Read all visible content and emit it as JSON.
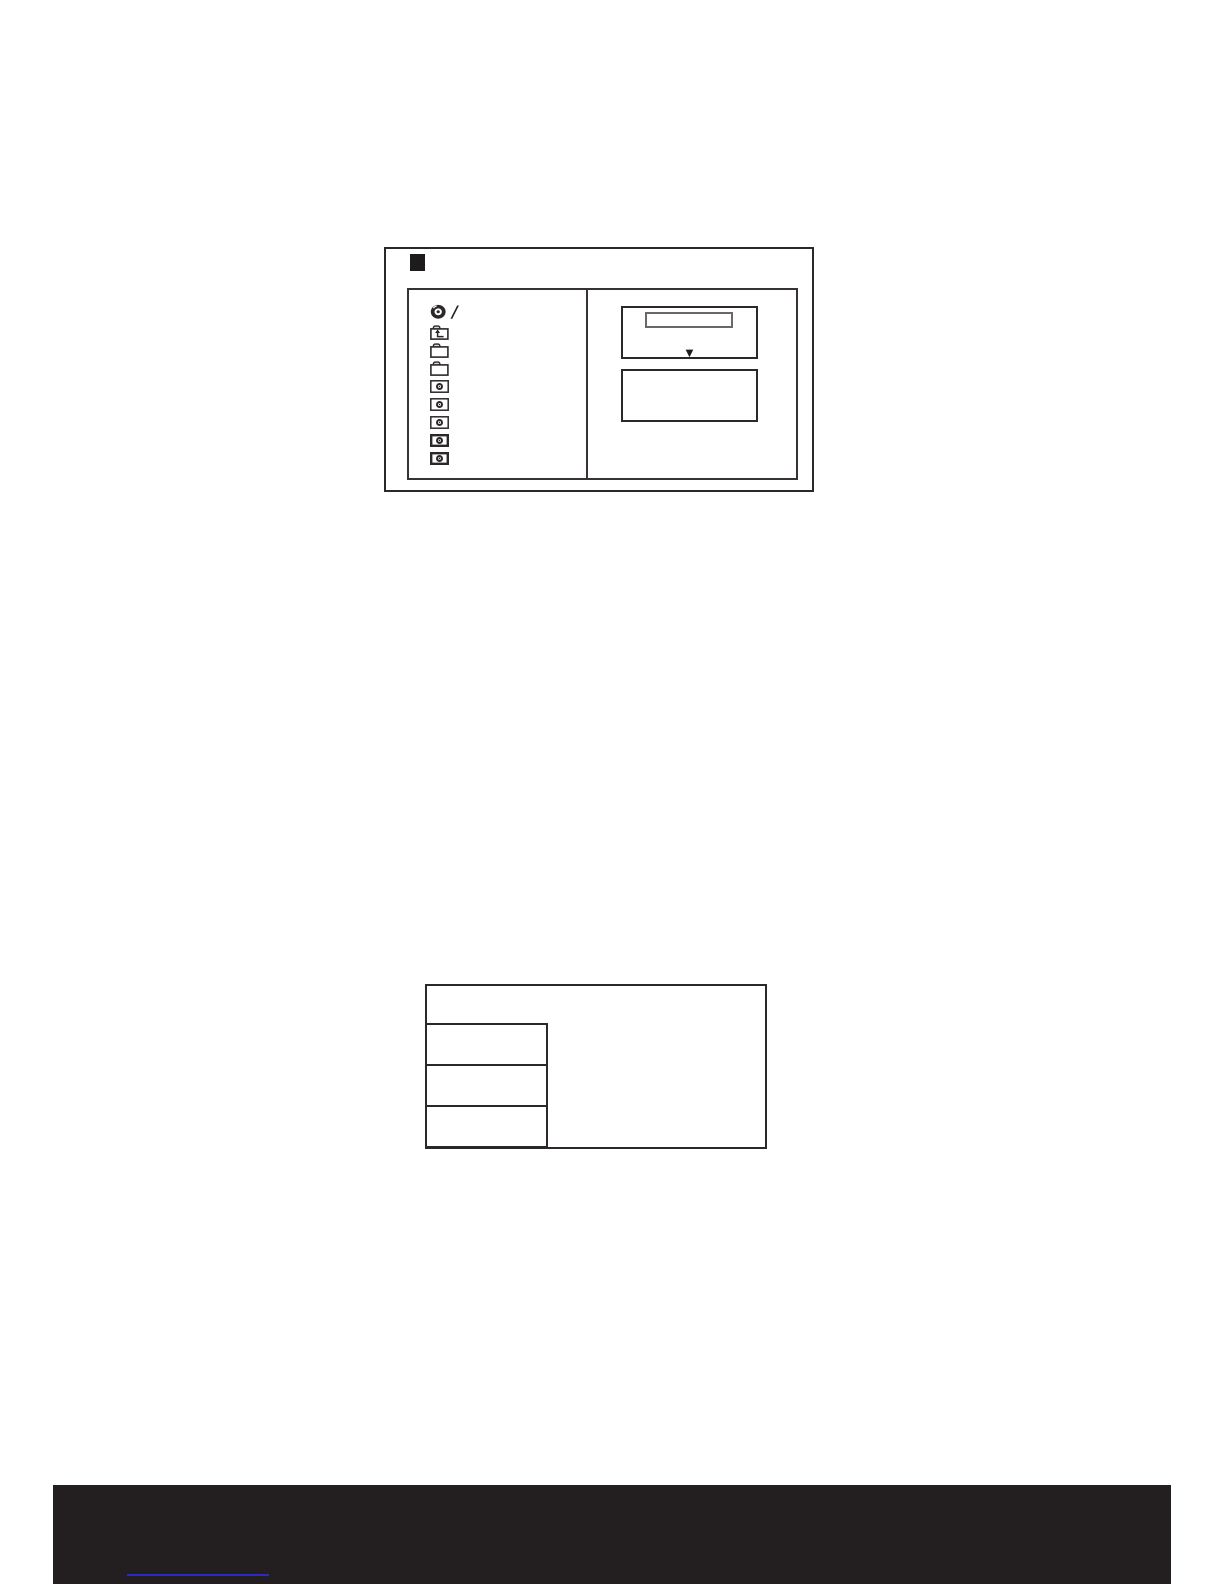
{
  "page": {
    "background": "#ffffff"
  },
  "figure_file_browser": {
    "step_marker_color": "#1e1b1c",
    "file_list": {
      "items": [
        {
          "icon": "disc",
          "label": "/"
        },
        {
          "icon": "folder-up",
          "label": ""
        },
        {
          "icon": "folder",
          "label": ""
        },
        {
          "icon": "folder",
          "label": ""
        },
        {
          "icon": "camera-file",
          "label": ""
        },
        {
          "icon": "camera-file",
          "label": ""
        },
        {
          "icon": "camera-file",
          "label": ""
        },
        {
          "icon": "camera-file",
          "label": "",
          "bold": true
        },
        {
          "icon": "camera-file",
          "label": "",
          "bold": true
        }
      ]
    },
    "preview_pane": {
      "dropdown_arrow": "▼"
    }
  },
  "figure_option_panel": {
    "option_boxes": 3
  },
  "footer": {
    "bar_color": "#231f20",
    "link_text": "",
    "link_underline_color": "#2a2ac4"
  }
}
